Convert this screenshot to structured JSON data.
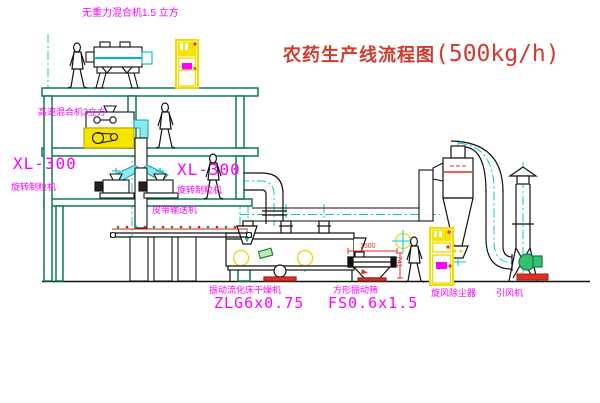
{
  "title": {
    "cn": "农药生产线流程图",
    "capacity": "(500kg/h)"
  },
  "equipment_labels": {
    "gravity_mixer": "无重力混合机1.5 立方",
    "high_speed_mixer": "高速混合机3立方",
    "granulator_left": {
      "model": "XL-300",
      "name": "旋转制粒机"
    },
    "granulator_right": {
      "model": "XL-300",
      "name": "旋转制粒机"
    },
    "belt_conveyor": "皮带输送机",
    "dryer": {
      "name": "振动流化床干燥机",
      "model": "ZLG6x0.75"
    },
    "screen": {
      "name": "方形振动筛",
      "model": "FS0.6x1.5"
    },
    "cyclone": "旋风除尘器",
    "fan": "引风机"
  },
  "dimensions": {
    "screen_length": "1500",
    "screen_height": "741"
  },
  "colors": {
    "title": "#d23a2e",
    "label": "#ff00ff",
    "structure": "#0a7a5a",
    "centerline": "#00cccc",
    "line": "#1a1a1a",
    "cabinet": "#f0dc00",
    "alert": "#e03020",
    "motor_green": "#22aa55"
  }
}
